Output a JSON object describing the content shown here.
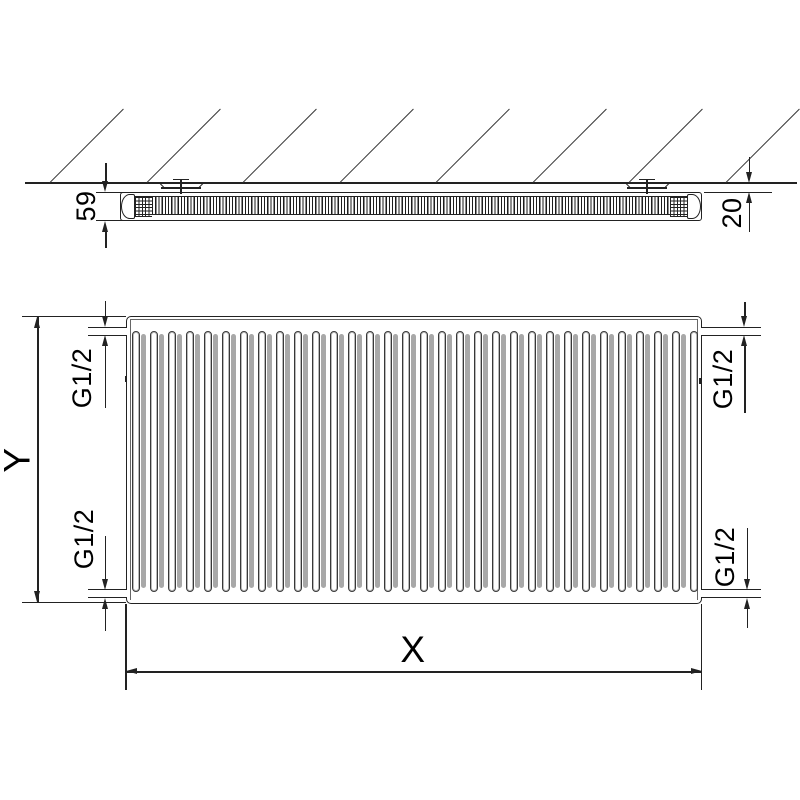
{
  "top_view": {
    "depth_label": "59",
    "wall_clearance_label": "20"
  },
  "front_view": {
    "height_label": "Y",
    "width_label": "X",
    "fin_count": 32,
    "connection_labels": {
      "top_left": "G1/2",
      "top_right": "G1/2",
      "bottom_left": "G1/2",
      "bottom_right": "G1/2"
    }
  },
  "colors": {
    "line": "#222222",
    "fin_shade": "#a8a8a8",
    "background": "#ffffff"
  },
  "hatch": {
    "count": 8
  }
}
